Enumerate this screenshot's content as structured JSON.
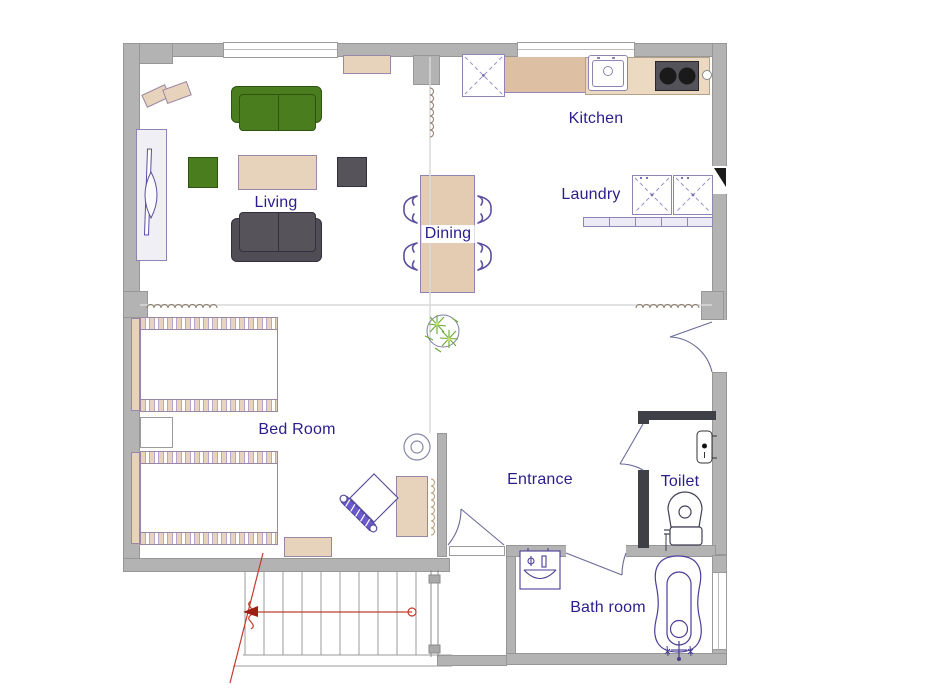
{
  "plan_title": "Apartment floor plan",
  "rooms": {
    "living": {
      "label": "Living"
    },
    "dining": {
      "label": "Dining"
    },
    "kitchen": {
      "label": "Kitchen"
    },
    "laundry": {
      "label": "Laundry"
    },
    "bedroom": {
      "label": "Bed Room"
    },
    "entrance": {
      "label": "Entrance"
    },
    "toilet": {
      "label": "Toilet"
    },
    "bathroom": {
      "label": "Bath room"
    }
  },
  "fixtures": {
    "living": [
      "sofa-green",
      "sofa-dark",
      "coffee-table",
      "armchair-green",
      "armchair-dark",
      "cabinet",
      "wall-shelf",
      "decor-cushions"
    ],
    "dining": [
      "dining-table",
      "chair",
      "chair",
      "chair",
      "chair",
      "potted-plant"
    ],
    "kitchen": [
      "refrigerator",
      "counter",
      "sink",
      "cooktop"
    ],
    "laundry": [
      "washing-machine",
      "washing-machine",
      "shelf"
    ],
    "bedroom": [
      "bed",
      "bed",
      "nightstand",
      "bench",
      "desk",
      "desk-chair"
    ],
    "entrance": [
      "round-table",
      "doors"
    ],
    "toilet": [
      "toilet",
      "paper-holder"
    ],
    "bathroom": [
      "bathtub",
      "wash-basin",
      "window"
    ],
    "stairs": [
      "treads",
      "direction-arrow",
      "break-line"
    ]
  },
  "colors": {
    "wall": "#b3b3b3",
    "wall_dark": "#3f3f48",
    "label_text": "#2a1d8c",
    "fixture_outline": "#5b4fa0",
    "furniture_beige": "#e7d3bb",
    "sofa_green": "#4a7d1e",
    "sofa_dark": "#56545a",
    "plant_green": "#68a832",
    "stair_annotation_red": "#c23b2e"
  }
}
